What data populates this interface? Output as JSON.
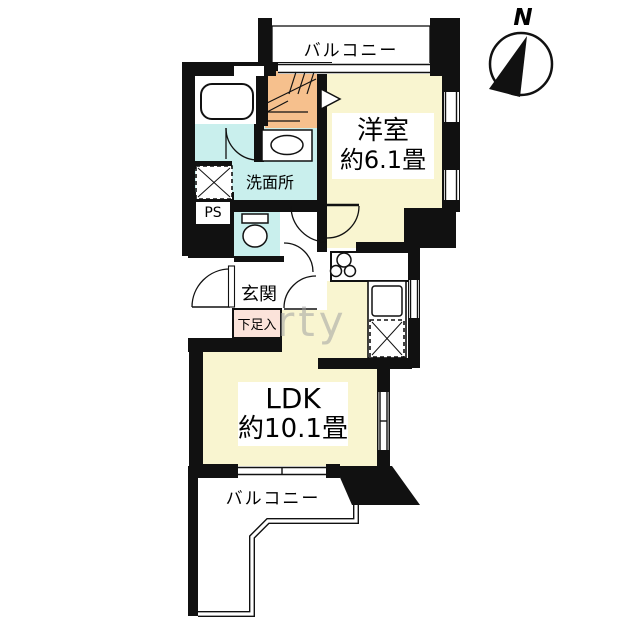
{
  "floorplan": {
    "compass": {
      "label": "N"
    },
    "balcony_top": {
      "label": "バルコニー"
    },
    "bedroom": {
      "label": "洋室",
      "size": "約6.1畳"
    },
    "washroom": {
      "label": "洗面所"
    },
    "pipe_space": {
      "label": "PS"
    },
    "entrance": {
      "label": "玄関"
    },
    "shoe_cabinet": {
      "label": "下足入"
    },
    "ldk": {
      "label": "LDK",
      "size": "約10.1畳"
    },
    "balcony_bottom": {
      "label": "バルコニー"
    },
    "watermark": {
      "text": "rty"
    },
    "colors": {
      "wall": "#111111",
      "room_yellow": "#f9f5d0",
      "wet_area_cyan": "#c9efed",
      "closet_orange": "#f6c08d",
      "shoe_cabinet_pink": "#fbe3da"
    },
    "fixtures": [
      "bathtub",
      "washbasin",
      "washing-machine-space",
      "toilet",
      "stove-burners",
      "kitchen-sink",
      "refrigerator-space"
    ]
  }
}
